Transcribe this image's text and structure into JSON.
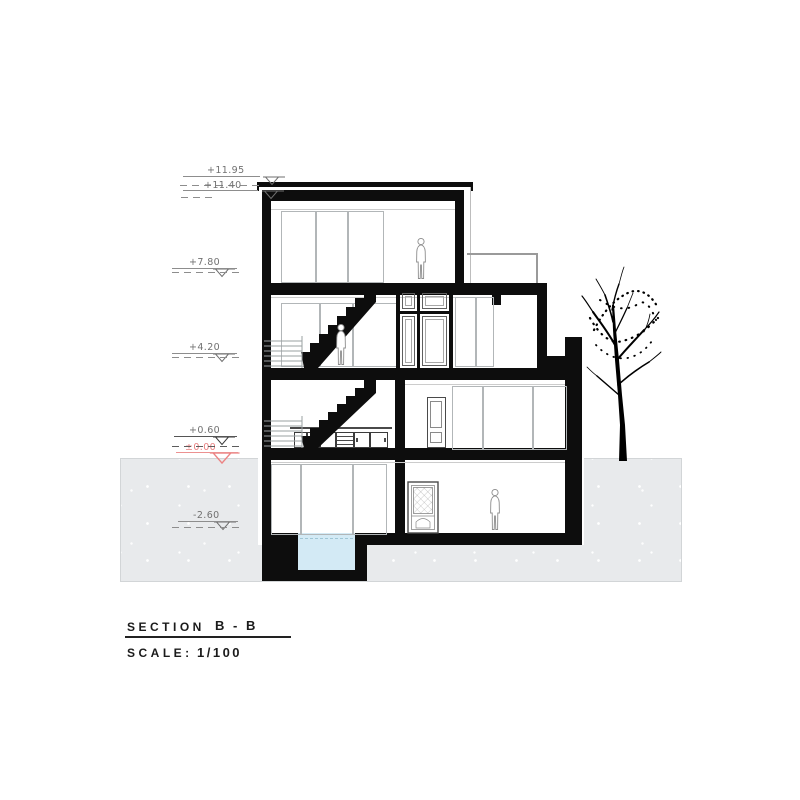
{
  "title_block": {
    "section_label": "SECTION",
    "section_value": "B - B",
    "scale_label": "SCALE:",
    "scale_value": "1/100"
  },
  "levels": [
    {
      "name": "parapet-top",
      "elevation": "+11.95"
    },
    {
      "name": "roof",
      "elevation": "+11.40"
    },
    {
      "name": "third-floor",
      "elevation": "+7.80"
    },
    {
      "name": "second-floor",
      "elevation": "+4.20"
    },
    {
      "name": "ground-floor",
      "elevation": "+0.60"
    },
    {
      "name": "street-level",
      "elevation": "±0.00"
    },
    {
      "name": "basement",
      "elevation": "-2.60"
    }
  ],
  "colors": {
    "ink": "#0d0d0d",
    "annotation_gray": "#717171",
    "grade_red": "#ec8383",
    "ground_fill": "#e8eaec",
    "water_fill": "#d3eaf5",
    "glazing_frame": "#b2b6b8"
  }
}
